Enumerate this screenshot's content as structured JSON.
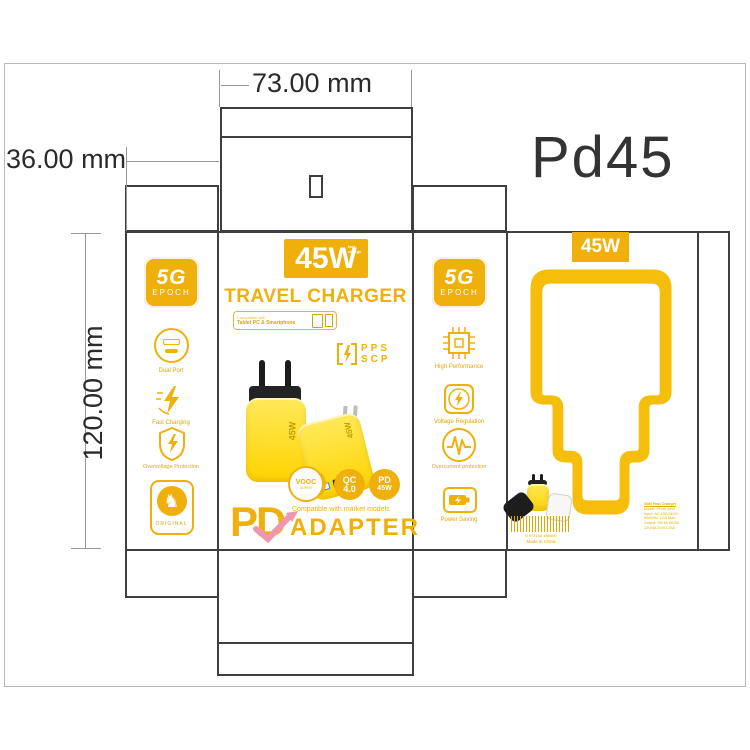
{
  "artboard": {
    "product_code": "Pd45"
  },
  "dims": {
    "width_label": "73.00 mm",
    "depth_label": "36.00 mm",
    "height_label": "120.00 mm"
  },
  "front": {
    "watt_badge": "45W",
    "watt_badge_sub": "fast charge",
    "title": "TRAVEL CHARGER",
    "compat_label": "Compatible with",
    "compat_devices": "Tablet PC & Smartphone",
    "pps_line1": "PPS",
    "pps_line2": "SCP",
    "product_watt": "45W",
    "circle_vooc": "VOOC",
    "circle_vooc_sub": "SUPER",
    "circle_qc_top": "QC",
    "circle_qc_bottom": "4.0",
    "circle_pd_top": "PD",
    "circle_pd_bottom": "45W",
    "brand_pd": "PD",
    "brand_tagline": "Compatible with market models",
    "brand_adapter": "ADAPTER"
  },
  "left_flap": {
    "badge_top": "5G",
    "badge_bottom": "EPOCH",
    "features": [
      {
        "label": "Dual Port"
      },
      {
        "label": "Fast Charging"
      },
      {
        "label": "Overvoltage Protection"
      },
      {
        "label": "ORIGINAL"
      }
    ]
  },
  "side_panel": {
    "badge_top": "5G",
    "badge_bottom": "EPOCH",
    "features": [
      {
        "label": "High Performance"
      },
      {
        "label": "Voltage Regulation"
      },
      {
        "label": "Overcurrent protection"
      },
      {
        "label": "Power Saving"
      }
    ]
  },
  "back": {
    "watt_badge": "45W",
    "barcode_digits": "6 972150 450450",
    "origin": "Made in China",
    "spec_lines": [
      "GaN Fast Charger",
      "Model: PD45 45W",
      "Input: AC 100-240V~",
      "50/60Hz 1.2A Max",
      "Output: 5V/3A 9V/3A",
      "12V/3A 20V/2.25A"
    ]
  },
  "colors": {
    "accent": "#F0B00C",
    "label_yellow": "#DFA60B",
    "product_yellow": "#FFD400",
    "pink": "#F096AE",
    "dieline": "#3E3E3E",
    "dim_gray": "#979797"
  }
}
